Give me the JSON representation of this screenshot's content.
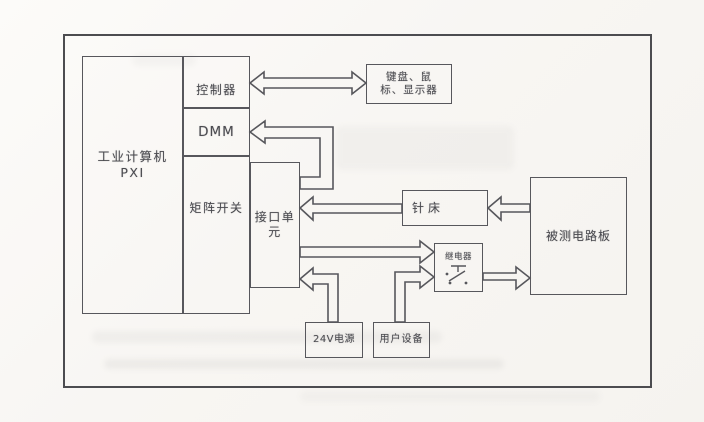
{
  "nodes": {
    "industrial_computer": {
      "line1": "工业计算机",
      "line2": "PXI"
    },
    "controller": {
      "label": "控制器"
    },
    "dmm": {
      "label": "DMM"
    },
    "matrix_switch": {
      "label": "矩阵开关"
    },
    "interface_unit": {
      "line1": "接口单",
      "line2": "元"
    },
    "keyboard_mouse_display": {
      "line1": "键盘、鼠",
      "line2": "标、显示器"
    },
    "needle_bed": {
      "label": "针床"
    },
    "board_under_test": {
      "label": "被测电路板"
    },
    "relay": {
      "label": "继电器"
    },
    "power_24v": {
      "label": "24V电源"
    },
    "user_equipment": {
      "label": "用户设备"
    }
  },
  "edges": [
    {
      "from": "controller",
      "to": "keyboard_mouse_display",
      "style": "hollow-arrow",
      "direction": "bidirectional"
    },
    {
      "from": "interface_unit",
      "to": "dmm",
      "style": "hollow-arrow",
      "direction": "one-way"
    },
    {
      "from": "needle_bed",
      "to": "interface_unit",
      "style": "hollow-arrow",
      "direction": "one-way"
    },
    {
      "from": "board_under_test",
      "to": "needle_bed",
      "style": "hollow-arrow",
      "direction": "one-way"
    },
    {
      "from": "interface_unit",
      "to": "relay",
      "style": "hollow-arrow",
      "direction": "one-way"
    },
    {
      "from": "user_equipment",
      "to": "relay",
      "style": "hollow-arrow",
      "direction": "one-way"
    },
    {
      "from": "power_24v",
      "to": "interface_unit",
      "style": "hollow-arrow",
      "direction": "one-way"
    },
    {
      "from": "relay",
      "to": "board_under_test",
      "style": "hollow-arrow",
      "direction": "one-way"
    }
  ],
  "colors": {
    "line": "#57575c",
    "text": "#4b4b50",
    "paper": "#f8f6f3"
  }
}
